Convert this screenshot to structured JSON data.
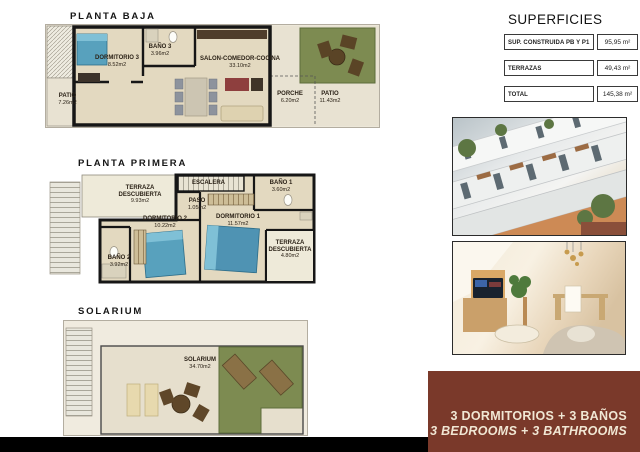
{
  "plans": {
    "planta_baja": {
      "title": "PLANTA BAJA",
      "rooms": {
        "dormitorio3": {
          "name": "DORMITORIO 3",
          "area": "8.52m2"
        },
        "bano3": {
          "name": "BAÑO 3",
          "area": "3.96m2"
        },
        "salon": {
          "name": "SALON-COMEDOR-COCINA",
          "area": "33.10m2"
        },
        "patio_izq": {
          "name": "PATIO",
          "area": "7.26m2"
        },
        "porche": {
          "name": "PORCHE",
          "area": "6.20m2"
        },
        "patio_der": {
          "name": "PATIO",
          "area": "11.43m2"
        }
      }
    },
    "planta_primera": {
      "title": "PLANTA PRIMERA",
      "rooms": {
        "terraza1": {
          "name": "TERRAZA DESCUBIERTA",
          "area": "9.93m2"
        },
        "escalera": {
          "name": "ESCALERA"
        },
        "bano1": {
          "name": "BAÑO 1",
          "area": "3.60m2"
        },
        "paso": {
          "name": "PASO",
          "area": "1.05m2"
        },
        "dormitorio2": {
          "name": "DORMITORIO 2",
          "area": "10.22m2"
        },
        "dormitorio1": {
          "name": "DORMITORIO 1",
          "area": "11.57m2"
        },
        "bano2": {
          "name": "BAÑO 2",
          "area": "3.92m2"
        },
        "terraza2": {
          "name": "TERRAZA DESCUBIERTA",
          "area": "4.80m2"
        }
      }
    },
    "solarium": {
      "title": "SOLARIUM",
      "rooms": {
        "solarium": {
          "name": "SOLARIUM",
          "area": "34.70m2"
        }
      }
    }
  },
  "superficies": {
    "title": "SUPERFICIES",
    "rows": [
      {
        "label": "SUP. CONSTRUIDA PB Y P1",
        "value": "95,95 m²"
      },
      {
        "label": "TERRAZAS",
        "value": "49,43 m²"
      },
      {
        "label": "TOTAL",
        "value": "145,38 m²"
      }
    ]
  },
  "banner": {
    "line1_es": "3 DORMITORIOS + 3 BAÑOS",
    "line2_en": "3 BEDROOMS + 3 BATHROOMS"
  },
  "colors": {
    "banner_bg": "#7a392a",
    "banner_text": "#f1e7d4",
    "grass_green": "#7d8b51",
    "floor_beige": "#e3d9c0",
    "wall_black": "#161616",
    "bed_blue": "#58a1bd"
  }
}
